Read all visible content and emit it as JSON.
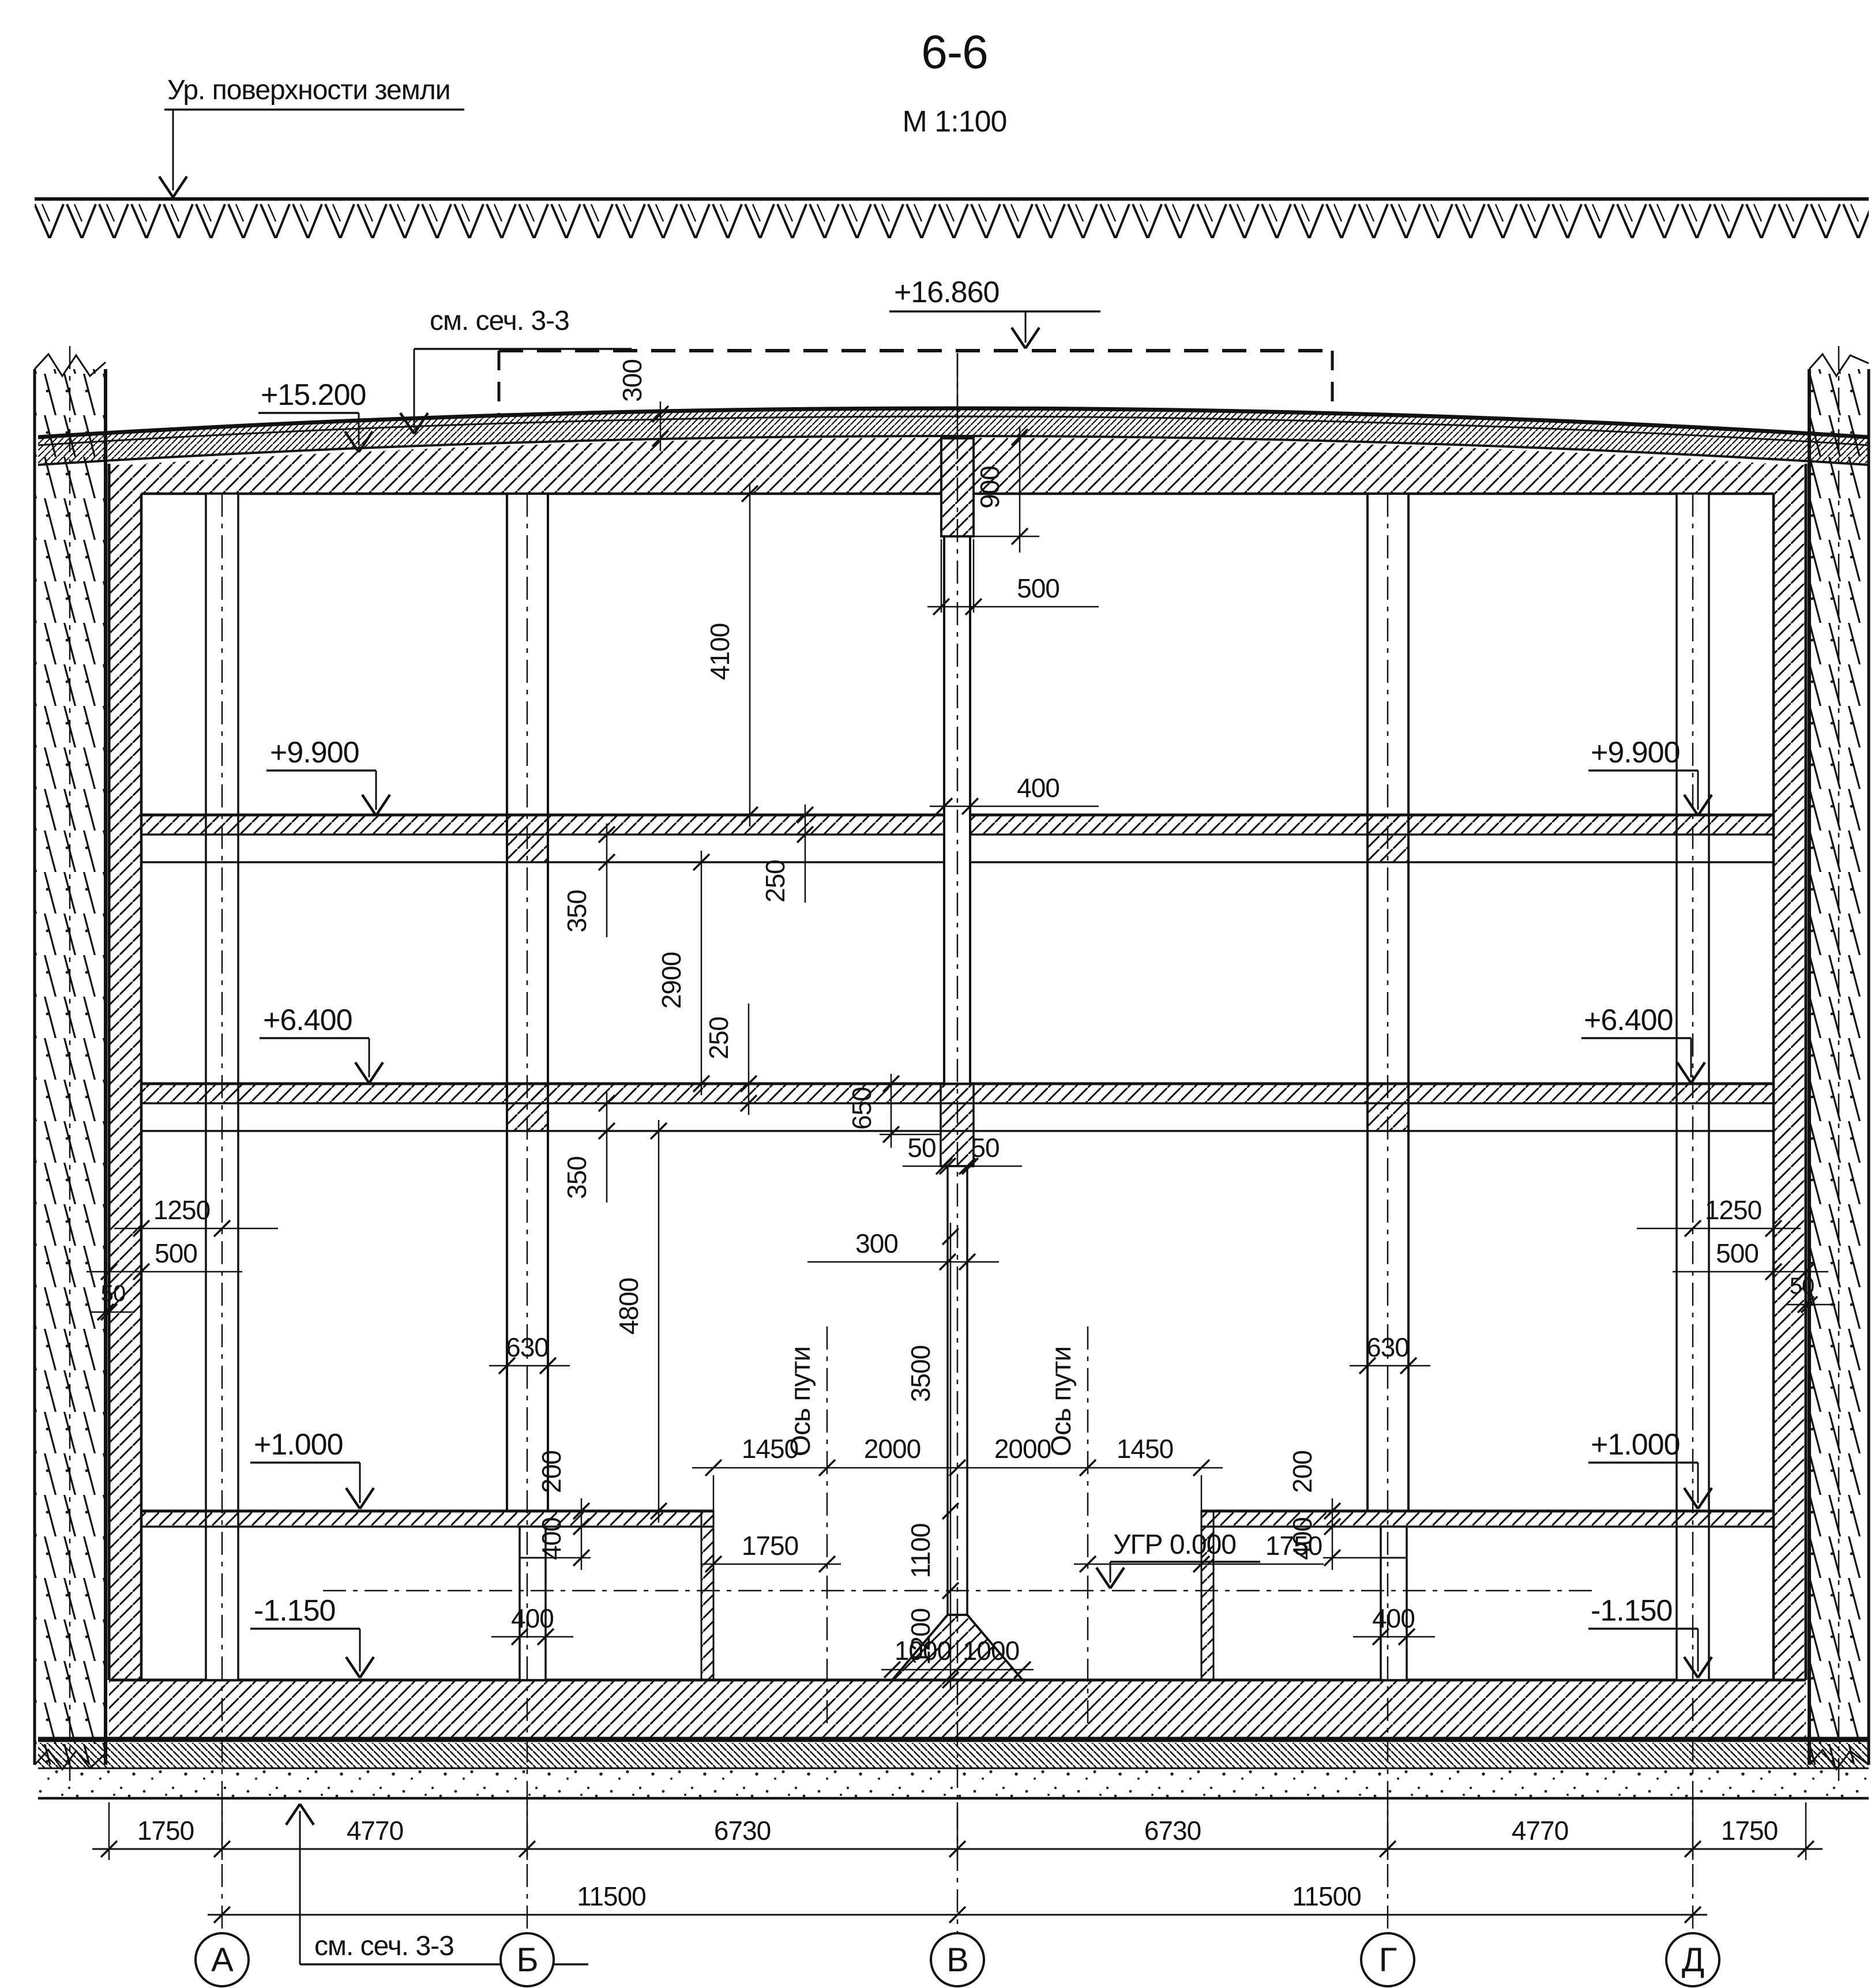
{
  "title": {
    "section": "6-6",
    "scale": "М 1:100"
  },
  "notes": {
    "ground_level": "Ур. поверхности земли",
    "see_section_top": "см. сеч. 3-3",
    "see_section_bottom": "см. сеч. 3-3",
    "rail_level": "УГР 0.000",
    "track_axis": "Ось пути"
  },
  "elevations": {
    "clearance": "+16.860",
    "roof": "+15.200",
    "level3": "+9.900",
    "level2": "+6.400",
    "platform": "+1.000",
    "invert": "-1.150"
  },
  "axes": {
    "a": "А",
    "b": "Б",
    "v": "В",
    "g": "Г",
    "d": "Д"
  },
  "dims": {
    "bottom": [
      "1750",
      "4770",
      "6730",
      "6730",
      "4770",
      "1750"
    ],
    "overall": "11500",
    "roof_cover": "300",
    "roof_beam": "900",
    "capital": "500",
    "column_upper": "400",
    "beam_depth": "650",
    "gap_l": "50",
    "gap_r": "50",
    "column_lower": "300",
    "column_height": "3500",
    "platform_rail": "1100",
    "rail_base": "1200",
    "pedestal_l": "1000",
    "pedestal_r": "1000",
    "track": [
      "1450",
      "2000",
      "2000",
      "1450"
    ],
    "platform_edge_l": "1750",
    "platform_edge_r": "1750",
    "stack": {
      "h1": "4100",
      "s1": "250",
      "b1": "350",
      "h2": "2900",
      "s2": "250",
      "b2": "350",
      "h3": "4800"
    },
    "column_width": "630",
    "notch_slab": "200",
    "notch_depth": "400",
    "notch_width": "400",
    "wall_axis": "1250",
    "wall_thk": "500",
    "wall_gap": "50"
  }
}
